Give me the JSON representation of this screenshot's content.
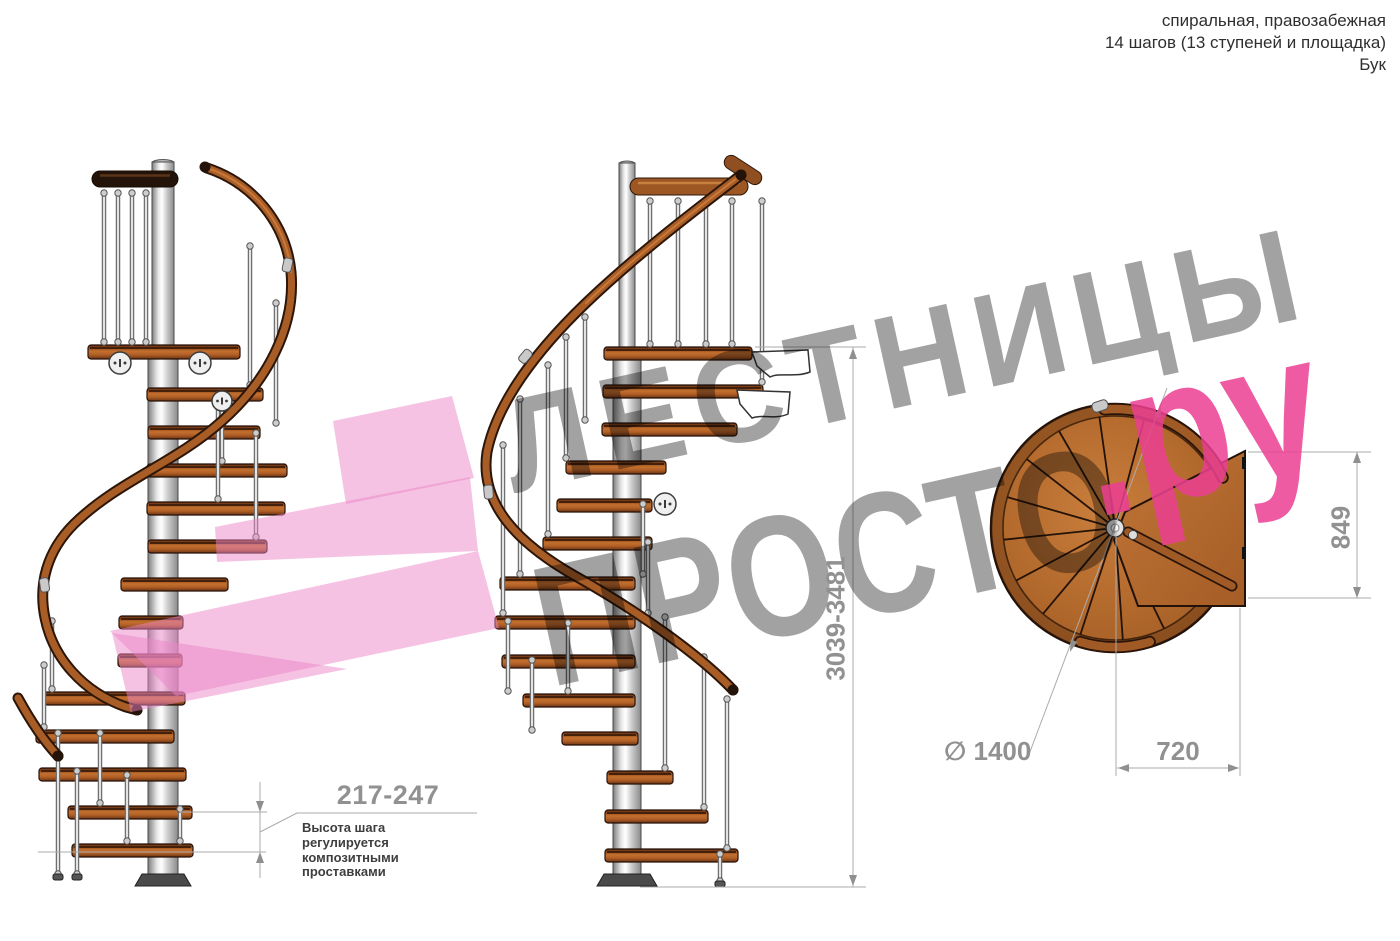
{
  "header": {
    "line1": "спиральная, правозабежная",
    "line2": "14 шагов (13 ступеней и площадка)",
    "line3": "Бук"
  },
  "watermark": {
    "word1": "ЛЕСТНИЦЫ",
    "word2": "ПРОСТО",
    "word3": ".ру"
  },
  "dimensions": {
    "step_height": "217-247",
    "step_note": [
      "Высота шага",
      "регулируется",
      "композитными",
      "проставками"
    ],
    "total_height": "3039-3481",
    "plan_depth": "849",
    "plan_width": "720",
    "diameter": "∅ 1400"
  },
  "colors": {
    "wood": "#b2692c",
    "wood_outline": "#26120a",
    "handrail": "#a85c26",
    "metal_pole": "#e8e8e8",
    "dimension_text": "#919191",
    "watermark_gray": "#a2a2a2",
    "logo_pink": "#ec3f92",
    "arrow_pink": "#ec86c8"
  }
}
